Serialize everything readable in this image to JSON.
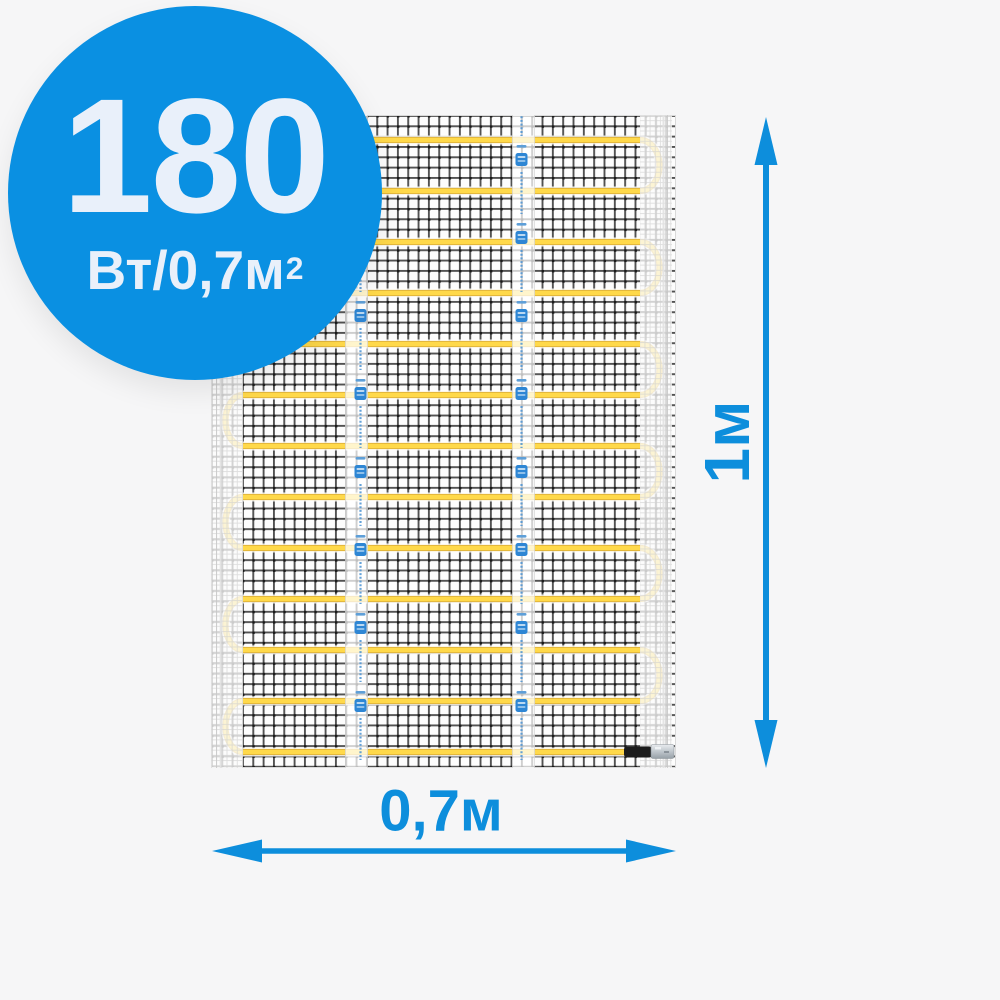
{
  "product_badge": {
    "value": "180",
    "unit": "Вт/0,7м",
    "unit_superscript": "2",
    "background_color": "#0A90E2",
    "text_color": "#E9F0FA"
  },
  "dimension_annotations": {
    "height_label": "1м",
    "width_label": "0,7м",
    "arrow_color": "#0D8EDC"
  },
  "product_image": {
    "type": "electric heating mat on mesh, serpentine heating cable",
    "heating_cable_color": "#FFD94A",
    "mesh_line_color": "#3A3A3A",
    "tape_logo_color": "#2E86D4",
    "yellow_cable_rows": 13,
    "icons": {
      "up-arrow-icon": "▲",
      "down-arrow-icon": "▼",
      "left-arrow-icon": "◀",
      "right-arrow-icon": "▶",
      "tape-logo-icon": "blue emblem stamp"
    }
  },
  "page": {
    "background_color": "#F6F6F7"
  }
}
